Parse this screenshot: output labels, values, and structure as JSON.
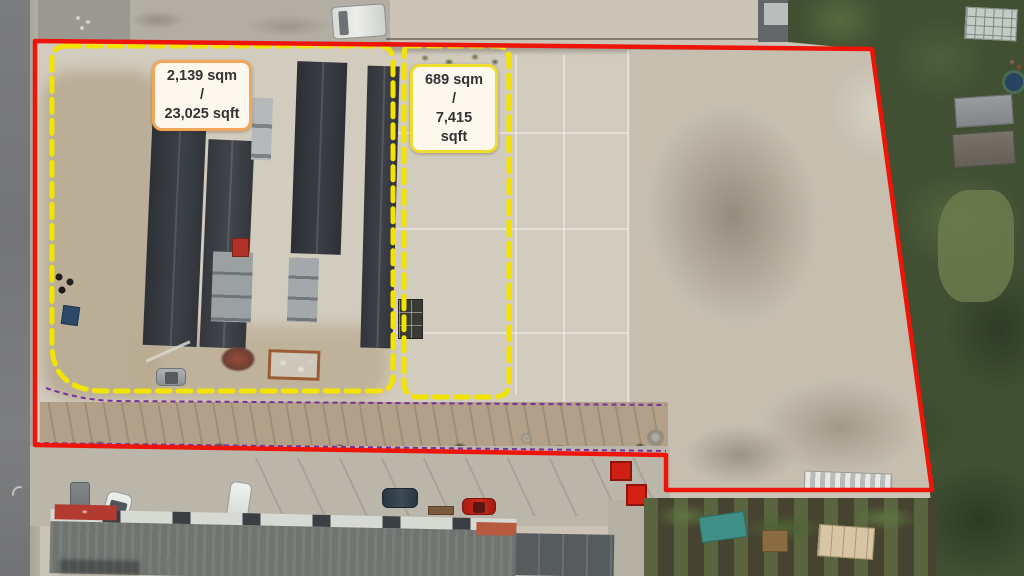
{
  "image": {
    "description": "Aerial drone photograph of a commercial storage yard with marked site and unit boundaries",
    "width_px": 1024,
    "height_px": 576
  },
  "annotations": {
    "site_boundary": {
      "name": "overall site boundary",
      "color": "#ee1408",
      "line_style": "solid"
    },
    "unit_left": {
      "area_label": "2,139 sqm /\n23,025 sqft",
      "area_sqm": "2,139",
      "area_sqft": "23,025",
      "boundary_color": "#f2e400",
      "line_style": "dashed",
      "label_bg": "#fdf8ee",
      "label_border": "#f1a65a",
      "label_text_color": "#333333"
    },
    "unit_right": {
      "area_label": "689 sqm /\n7,415 sqft",
      "area_sqm": "689",
      "area_sqft": "7,415",
      "boundary_color": "#f2e400",
      "line_style": "dashed",
      "label_bg": "#fdf8ee",
      "label_border": "#eedd2e",
      "label_text_color": "#333333"
    },
    "access_strip": {
      "boundary_color": "#7a2f9e",
      "line_style": "dashed"
    }
  },
  "scene": {
    "shipping_container_colors": [
      "#9a4f40",
      "#c4694a",
      "#b6bab8",
      "#79a8b8",
      "#4e7d7d",
      "#b04a3c",
      "#8a4436",
      "#3f6b70",
      "#c05a40",
      "#c98777",
      "#8d4a3c",
      "#7b8486"
    ]
  }
}
